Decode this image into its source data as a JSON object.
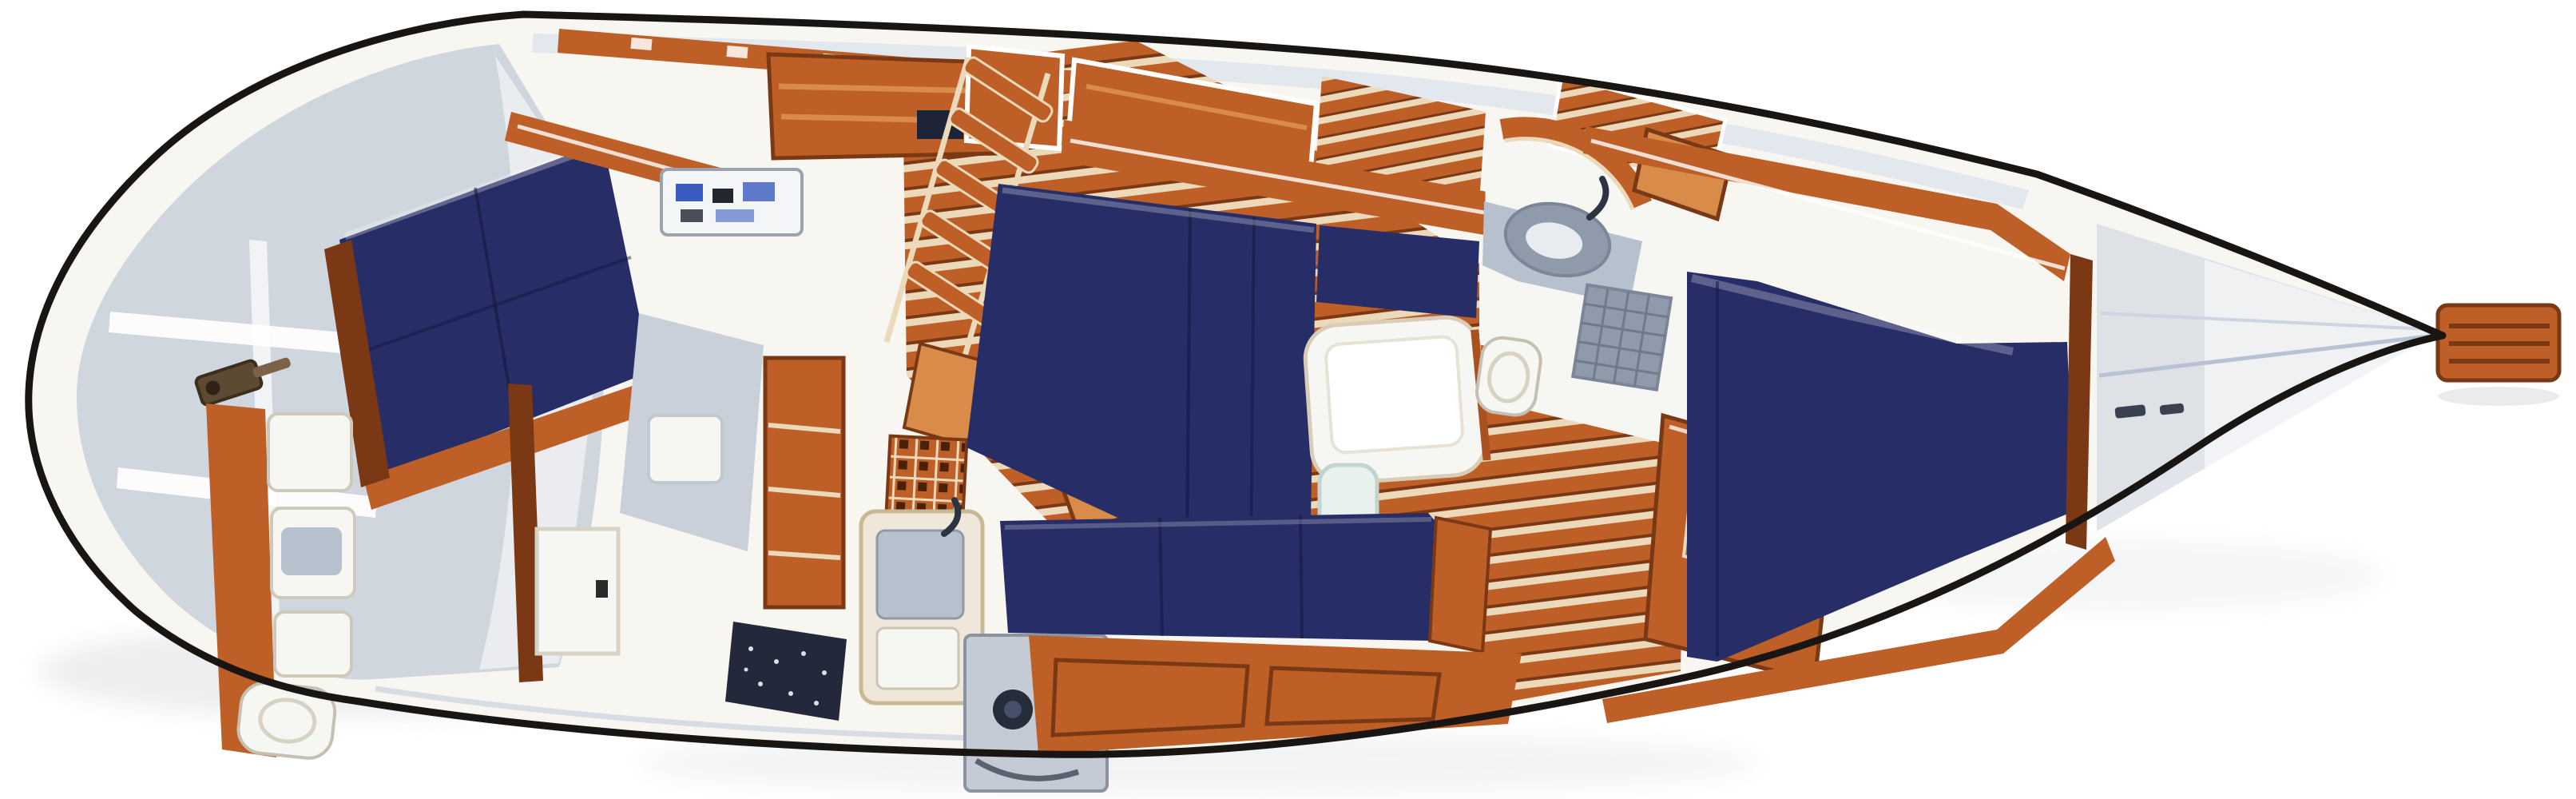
{
  "page": {
    "title": "Sailboat interior arrangement plan",
    "view": "overhead cutaway floor plan illustration",
    "orientation": "stern at left, bow at right",
    "background": "#ffffff"
  },
  "palette": {
    "hull_outline": "#181512",
    "interior": "#f8f6f1",
    "deck_wash": "#e3e7ee",
    "molded_gray": "#c9d0da",
    "molded_gray_dark": "#a9b2c1",
    "berth_navy": "#272d66",
    "berth_navy_light": "#47568f",
    "teak_mid": "#bd5f26",
    "teak_dark": "#7a3814",
    "teak_light": "#d98c4a",
    "holly_cream": "#ecd9ba",
    "counter_cream": "#efe8da",
    "fixture_white": "#f6f6f3",
    "steel_gray": "#b7c0cd",
    "steel_gray_deep": "#8f9aab",
    "stove_gray": "#c5cbd5",
    "burner_dark": "#252c3a",
    "speckle_counter": "#23283a",
    "panel_white": "#f4f5f7",
    "instrument_blue": "#3a5bbf",
    "hardware_brown": "#5d4a33",
    "shadow": "#9aa0ab"
  },
  "areas": {
    "stern_lazarette": {
      "label": "stern lazarette with molded shelves and steering hardware"
    },
    "aft_cabin": {
      "label": "aft cabin double berth with hull shelf and vanity"
    },
    "aft_head": {
      "label": "aft head compartment with lockers, fixtures and door"
    },
    "nav_station": {
      "label": "navigation station with chart table and instrument panel"
    },
    "companionway": {
      "label": "companionway ladder, hatch boards and sea hood"
    },
    "galley": {
      "label": "galley with icebox grate, double sink, stove and counters"
    },
    "salon": {
      "label": "salon with port L-settee, starboard settee and table"
    },
    "forward_head": {
      "label": "forward head with curved door, vanity sink, toilet, shower grate"
    },
    "hanging_locker": {
      "label": "louvered hanging locker"
    },
    "forward_cabin": {
      "label": "forward cabin V-berth with hull shelf rails"
    },
    "anchor_locker": {
      "label": "anchor locker in bow"
    },
    "bowsprit": {
      "label": "bowsprit anchor platform"
    },
    "cabin_sole": {
      "label": "teak and holly cabin sole"
    }
  }
}
